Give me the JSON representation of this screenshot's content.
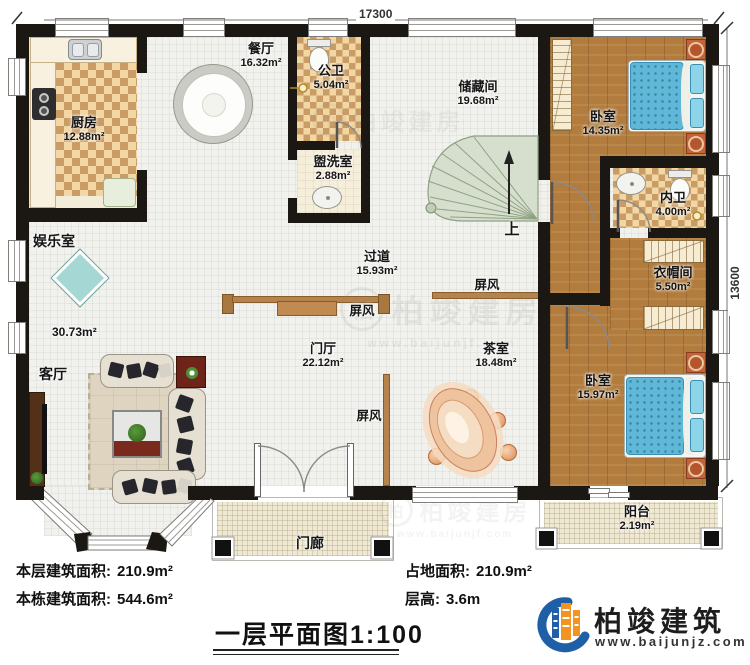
{
  "meta": {
    "type": "floor-plan"
  },
  "dimensions": {
    "top": "17300",
    "right": "13600"
  },
  "rooms": {
    "kitchen": {
      "label": "厨房",
      "area": "12.88m²"
    },
    "dining": {
      "label": "餐厅",
      "area": "16.32m²"
    },
    "public_bath": {
      "label": "公卫",
      "area": "5.04m²"
    },
    "washroom": {
      "label": "盥洗室",
      "area": "2.88m²"
    },
    "storage": {
      "label": "储藏间",
      "area": "19.68m²"
    },
    "bedroom_top": {
      "label": "卧室",
      "area": "14.35m²"
    },
    "inner_bath": {
      "label": "内卫",
      "area": "4.00m²"
    },
    "entertainment": {
      "label": "娱乐室",
      "area": "30.73m²"
    },
    "living": {
      "label": "客厅"
    },
    "corridor": {
      "label": "过道",
      "area": "15.93m²"
    },
    "foyer": {
      "label": "门厅",
      "area": "22.12m²"
    },
    "tearoom": {
      "label": "茶室",
      "area": "18.48m²"
    },
    "cloakroom": {
      "label": "衣帽间",
      "area": "5.50m²"
    },
    "bedroom_bottom": {
      "label": "卧室",
      "area": "15.97m²"
    },
    "balcony": {
      "label": "阳台",
      "area": "2.19m²"
    },
    "porch": {
      "label": "门廊"
    }
  },
  "labels": {
    "screen": "屏风",
    "up": "上"
  },
  "stats": {
    "floor_area": {
      "label": "本层建筑面积:",
      "value": "210.9m²"
    },
    "building_area": {
      "label": "本栋建筑面积:",
      "value": "544.6m²"
    },
    "land_area": {
      "label": "占地面积:",
      "value": "210.9m²"
    },
    "floor_height": {
      "label": "层高:",
      "value": "3.6m"
    }
  },
  "title": {
    "text": "一层平面图",
    "scale": "1:100"
  },
  "logo": {
    "brand": "柏竣建筑",
    "website": "www.baijunjz.com"
  },
  "watermark": {
    "brand": "柏竣建房",
    "website": "www.baijunjf.com",
    "initial": "柏"
  },
  "palette": {
    "wall": "#1b1713",
    "wood": "#b17c3e",
    "checker": "#c99c66",
    "bed": "#5fb8d8",
    "stairs": "#d6dfcd",
    "screen_wood": "#b5834e",
    "logo_blue": "#1e5fa6",
    "logo_orange": "#f29422"
  }
}
